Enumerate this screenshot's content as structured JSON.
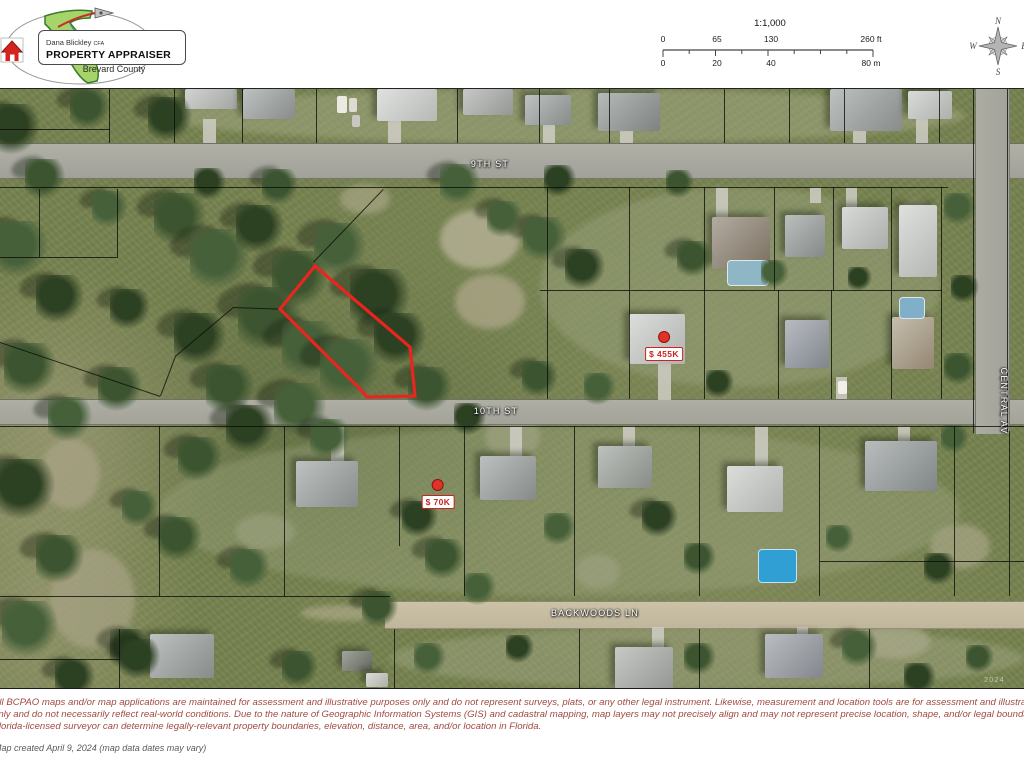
{
  "header": {
    "appraiser_name": "Dana Blickley",
    "appraiser_credential": "CFA",
    "office_title": "PROPERTY APPRAISER",
    "county": "Brevard County",
    "scale": {
      "ratio": "1:1,000",
      "feet": [
        "0",
        "65",
        "130",
        "260 ft"
      ],
      "meters": [
        "0",
        "20",
        "40",
        "80 m"
      ]
    },
    "compass": {
      "n": "N",
      "w": "W",
      "e": "E",
      "s": "S"
    }
  },
  "map": {
    "streets": {
      "top": "9TH ST",
      "mid": "10TH ST",
      "backwoods": "BACKWOODS LN",
      "central": "CENTRAL AV"
    },
    "markers": [
      {
        "label": "$ 455K"
      },
      {
        "label": "$ 70K"
      }
    ],
    "highlighted_parcel_color": "#e8251f",
    "watermark": "2024"
  },
  "footer": {
    "disclaimer": [
      "All BCPAO maps and/or map applications are maintained for assessment and illustrative purposes only and do not represent surveys, plats, or any other legal instrument. Likewise, measurement and location tools are for assessment and illustrative purposes",
      "only and do not necessarily reflect real-world conditions. Due to the nature of Geographic Information Systems (GIS) and cadastral mapping, map layers may not precisely align and may not represent precise location, shape, and/or legal boundaries. Only a",
      "Florida-licensed surveyor can determine legally-relevant property boundaries, elevation, distance, area, and/or location in Florida."
    ],
    "map_created": "Map created April 9, 2024 (map data dates may vary)"
  },
  "colors": {
    "parcel_highlight": "#e8251f",
    "marker_red": "#c92420",
    "disclaimer_red": "#a04a42",
    "road_gray": "#a8a8a0",
    "dirt_road_tan": "#c5bca2",
    "logo_green": "#a6d46a",
    "logo_house_red": "#d42420"
  }
}
